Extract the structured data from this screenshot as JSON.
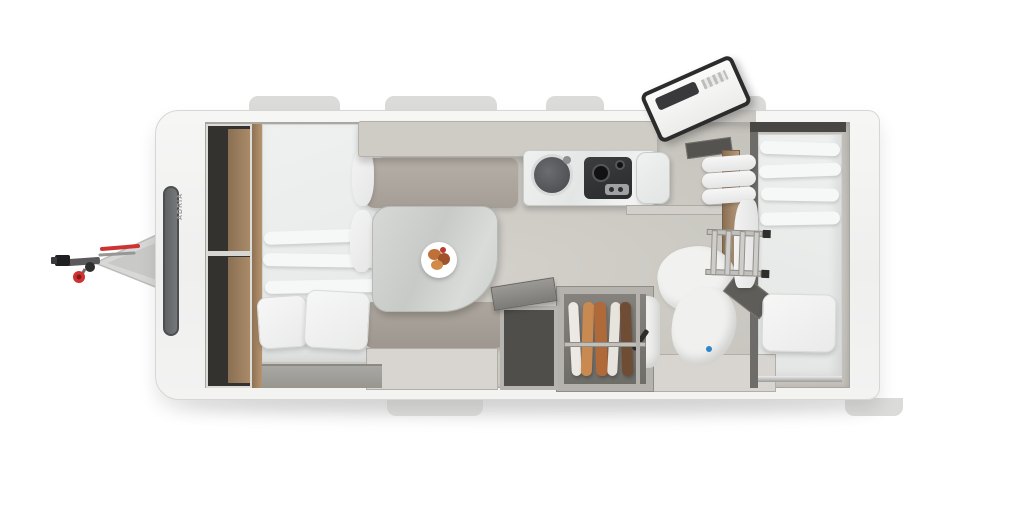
{
  "scene": {
    "type": "caravan-floorplan-top-view",
    "description": "Top-down 3D rendered floor plan of a single-axle travel caravan with hitch on the left",
    "brand_text": "ADRIA"
  },
  "colors": {
    "window-tab": "#dbdbda",
    "locker-frame": "#cfccc6",
    "wood": "#aa8258",
    "mattress-fold": "#f6f7f7",
    "plate": "#ffffff",
    "door-frame": "#2c2c2c",
    "accent-red": "#cc3434",
    "accent-blue": "#2f86c9",
    "shell": "#f4f4f3",
    "floor": "#cdcac4"
  },
  "features": [
    "hitch-drawbar",
    "jockey-wheel",
    "coupling-head",
    "red-release-lever",
    "front-panorama-window",
    "front-wardrobe-cabinets",
    "front-double-bed",
    "pillows",
    "overhead-lockers",
    "dinette-sofa-top",
    "dinette-sofa-bottom",
    "dinette-table",
    "breakfast-plate",
    "under-seat-storage",
    "kitchen-counter",
    "kitchen-sink",
    "gas-hob",
    "worktop-extension",
    "entry-door-open",
    "door-step",
    "storage-chest-open-lid",
    "wardrobe-with-hanging-clothes",
    "shower-bathroom",
    "shower-drain",
    "bathroom-door-open",
    "bunk-ladder",
    "rolled-bedding",
    "rear-single-bed",
    "windows-top",
    "windows-bottom"
  ]
}
